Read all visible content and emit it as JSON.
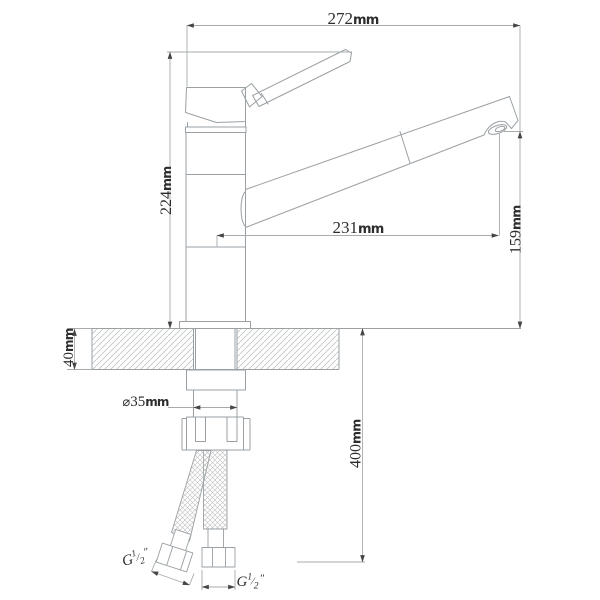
{
  "drawing": {
    "background": "#ffffff",
    "line_color": "#9aa0a4",
    "dim_line_color": "#a6abae",
    "arrow_color": "#454545",
    "text_color": "#2d2d2d",
    "hatch_color": "#c4c7c9",
    "braid_color": "#bfbfbf",
    "dimensions": {
      "overall_width": {
        "value": "272",
        "unit": "mm"
      },
      "height_to_handle": {
        "value": "224",
        "unit": "mm"
      },
      "spout_reach": {
        "value": "231",
        "unit": "mm"
      },
      "outlet_height": {
        "value": "159",
        "unit": "mm"
      },
      "counter_thickness": {
        "value": "40",
        "unit": "mm"
      },
      "hole_diameter": {
        "symbol": "⌀",
        "value": "35",
        "unit": "mm"
      },
      "hose_drop": {
        "value": "400",
        "unit": "mm"
      },
      "left_thread": {
        "prefix": "G",
        "numerator": "1",
        "slash": "⁄",
        "denominator": "2",
        "suffix": "″"
      },
      "right_thread": {
        "prefix": "G",
        "numerator": "1",
        "slash": "⁄",
        "denominator": "2",
        "suffix": "″"
      }
    }
  }
}
